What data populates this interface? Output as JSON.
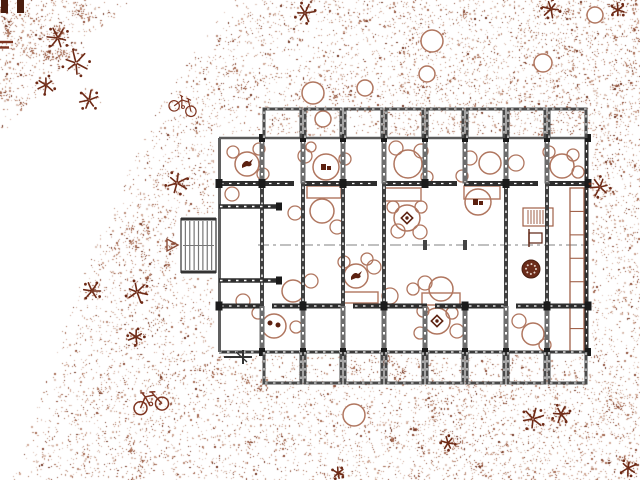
{
  "canvas": {
    "width": 640,
    "height": 480,
    "background": "#ffffff"
  },
  "palette": {
    "wall_dark": "#2e2e2e",
    "wall_gray": "#6d6d6d",
    "wall_light": "#9a9a9a",
    "furniture": "#b0765f",
    "furniture_dark": "#5c2110",
    "landscape": "#7e3420",
    "plant_dark": "#6e2a16",
    "stipple": [
      "#dcc3b7",
      "#cfa795",
      "#b98a76",
      "#a56a52",
      "#8a4a35",
      "#6f3320"
    ]
  },
  "building": {
    "slab": {
      "x": 217,
      "y": 137,
      "w": 372,
      "h": 216
    },
    "columns_x": [
      262,
      303,
      343,
      384,
      425,
      465,
      506,
      547,
      588
    ],
    "top_bays": {
      "y_top": 109,
      "y_bottom": 138
    },
    "bottom_bays": {
      "y_top": 352,
      "y_bottom": 383
    },
    "wall_rows": {
      "top_y": 138,
      "upper_y": 183.5,
      "lower_y": 306,
      "bottom_y": 352
    },
    "upper_wall_segments": [
      [
        219,
        294
      ],
      [
        302,
        377
      ],
      [
        383,
        457
      ],
      [
        464,
        538
      ],
      [
        545,
        588
      ]
    ],
    "lower_wall_segments": [
      [
        219,
        264
      ],
      [
        272,
        345
      ],
      [
        353,
        427
      ],
      [
        435,
        508
      ],
      [
        516,
        588
      ]
    ],
    "row1_wall_cols": [
      262,
      303,
      343,
      384,
      425,
      465,
      506,
      547
    ],
    "row3_wall_cols": [
      262,
      303,
      343,
      384,
      425,
      465,
      506,
      547
    ],
    "mid_wall_cols": [
      262,
      303,
      343,
      384,
      506,
      547
    ],
    "mid_ticks": [
      425,
      465
    ],
    "upper_junction_cols": [
      219,
      262,
      343,
      425,
      506,
      588
    ],
    "lower_junction_cols": [
      219,
      303,
      384,
      465,
      547,
      588
    ],
    "centerline": {
      "y": 245,
      "x1": 258,
      "x2": 586
    },
    "combs": [
      {
        "x1": 219,
        "x2": 279,
        "y": 206.5
      },
      {
        "x1": 219,
        "x2": 279,
        "y": 280.5
      }
    ],
    "stair": {
      "x": 181,
      "y": 219,
      "w": 35,
      "h": 53,
      "treads": 7,
      "arrow": [
        [
          167,
          239
        ],
        [
          167,
          251
        ],
        [
          178,
          245
        ]
      ]
    },
    "gate_mark": {
      "x": 243,
      "y": 357
    }
  },
  "furniture": {
    "tables": [
      {
        "x": 247,
        "y": 164,
        "r": 12,
        "glyph": "bird"
      },
      {
        "x": 326,
        "y": 167,
        "r": 13,
        "glyph": "block"
      },
      {
        "x": 408,
        "y": 164,
        "r": 14,
        "glyph": ""
      },
      {
        "x": 490,
        "y": 163,
        "r": 11,
        "glyph": ""
      },
      {
        "x": 562,
        "y": 166,
        "r": 12,
        "glyph": ""
      },
      {
        "x": 322,
        "y": 211,
        "r": 12,
        "glyph": ""
      },
      {
        "x": 407,
        "y": 218,
        "r": 13,
        "glyph": "diamond"
      },
      {
        "x": 478,
        "y": 202,
        "r": 13,
        "glyph": "block"
      },
      {
        "x": 356,
        "y": 276,
        "r": 12,
        "glyph": "bird"
      },
      {
        "x": 441,
        "y": 289,
        "r": 12,
        "glyph": ""
      },
      {
        "x": 293,
        "y": 291,
        "r": 11,
        "glyph": ""
      },
      {
        "x": 274,
        "y": 326,
        "r": 12,
        "glyph": "dots"
      },
      {
        "x": 437,
        "y": 321,
        "r": 13,
        "glyph": "diamond"
      },
      {
        "x": 533,
        "y": 334,
        "r": 11,
        "glyph": ""
      }
    ],
    "chairs": [
      [
        233,
        152,
        6
      ],
      [
        259,
        149,
        6
      ],
      [
        263,
        174,
        6
      ],
      [
        232,
        194,
        7
      ],
      [
        305,
        156,
        7
      ],
      [
        311,
        147,
        5
      ],
      [
        345,
        159,
        6
      ],
      [
        396,
        148,
        7
      ],
      [
        421,
        151,
        7
      ],
      [
        427,
        177,
        6
      ],
      [
        470,
        158,
        7
      ],
      [
        516,
        163,
        8
      ],
      [
        462,
        176,
        6
      ],
      [
        549,
        152,
        6
      ],
      [
        573,
        155,
        6
      ],
      [
        578,
        172,
        6
      ],
      [
        337,
        227,
        7
      ],
      [
        295,
        213,
        7
      ],
      [
        393,
        207,
        6
      ],
      [
        421,
        207,
        6
      ],
      [
        398,
        231,
        7
      ],
      [
        420,
        232,
        7
      ],
      [
        344,
        262,
        6
      ],
      [
        367,
        259,
        6
      ],
      [
        374,
        267,
        7
      ],
      [
        425,
        283,
        7
      ],
      [
        413,
        289,
        6
      ],
      [
        390,
        296,
        8
      ],
      [
        311,
        281,
        7
      ],
      [
        258,
        313,
        6
      ],
      [
        296,
        327,
        6
      ],
      [
        243,
        301,
        7
      ],
      [
        423,
        311,
        6
      ],
      [
        452,
        313,
        6
      ],
      [
        457,
        331,
        7
      ],
      [
        420,
        333,
        6
      ],
      [
        519,
        321,
        7
      ],
      [
        545,
        345,
        6
      ]
    ],
    "benches": [
      [
        307,
        186,
        34,
        12
      ],
      [
        384,
        188,
        37,
        13
      ],
      [
        464,
        186,
        36,
        13
      ],
      [
        422,
        293,
        38,
        12
      ],
      [
        342,
        292,
        36,
        11
      ]
    ],
    "shelf": {
      "x": 570,
      "y": 188,
      "w": 14,
      "h": 164,
      "cells": 7
    },
    "hatch_box": {
      "x": 523,
      "y": 208,
      "w": 30,
      "h": 18
    },
    "f_station": {
      "x": 529,
      "y": 229
    },
    "dark_disc": {
      "x": 531,
      "y": 269,
      "r": 9
    }
  },
  "landscape": {
    "trees": [
      [
        313,
        93,
        11
      ],
      [
        323,
        119,
        8
      ],
      [
        365,
        88,
        8
      ],
      [
        432,
        41,
        11
      ],
      [
        427,
        74,
        8
      ],
      [
        543,
        63,
        9
      ],
      [
        595,
        15,
        8
      ],
      [
        354,
        415,
        11
      ]
    ],
    "plants": [
      [
        58,
        38,
        11
      ],
      [
        76,
        63,
        13
      ],
      [
        46,
        85,
        9
      ],
      [
        89,
        100,
        10
      ],
      [
        305,
        13,
        10
      ],
      [
        551,
        9,
        9
      ],
      [
        618,
        10,
        7
      ],
      [
        177,
        183,
        11
      ],
      [
        600,
        187,
        10
      ],
      [
        92,
        291,
        9
      ],
      [
        137,
        292,
        11
      ],
      [
        136,
        337,
        8
      ],
      [
        533,
        419,
        11
      ],
      [
        561,
        414,
        9
      ],
      [
        448,
        443,
        7
      ],
      [
        338,
        473,
        6
      ],
      [
        628,
        468,
        8
      ]
    ],
    "bikes": [
      {
        "x": 150,
        "y": 400,
        "rot": -12,
        "s": 1.0
      },
      {
        "x": 184,
        "y": 104,
        "rot": 18,
        "s": 0.8
      }
    ],
    "corner_bars": [
      [
        1,
        0,
        7,
        13
      ],
      [
        17,
        0,
        7,
        13
      ]
    ],
    "corner_dashes": [
      [
        0,
        42,
        13
      ],
      [
        0,
        47.5,
        9
      ]
    ]
  },
  "stipple": {
    "seed": 7,
    "samples": 26000,
    "boundary": [
      [
        230,
        0
      ],
      [
        155,
        120
      ],
      [
        82,
        280
      ],
      [
        15,
        480
      ]
    ],
    "cluster_tri": {
      "x": 130,
      "y": 135
    },
    "masks": [
      [
        214,
        135,
        378,
        220
      ],
      [
        177,
        215,
        41,
        62
      ]
    ],
    "blotches": 60
  }
}
